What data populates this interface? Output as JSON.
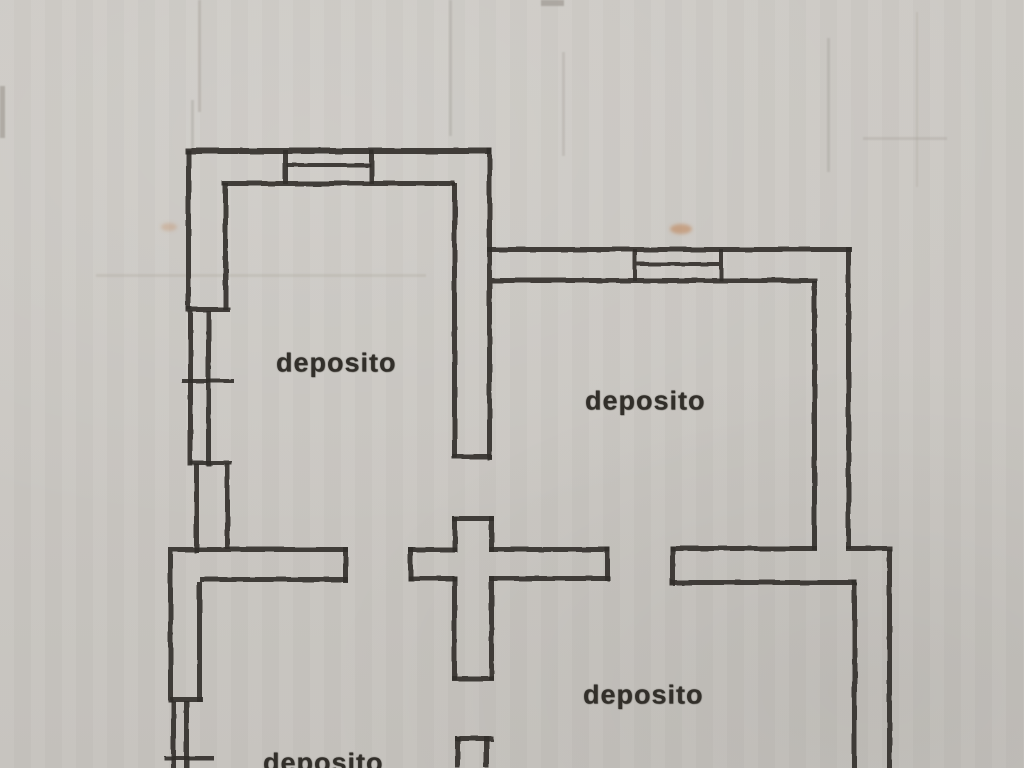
{
  "document": {
    "kind": "scanned cadastral floor plan (planimetria)",
    "language": "it"
  },
  "colors": {
    "paper": "#cac7c2",
    "ink": "#33302b",
    "faint": "#a9a49d",
    "smudge": "#c08050"
  },
  "rooms": [
    {
      "id": "deposito-1",
      "label": "deposito",
      "x": 276,
      "y": 348
    },
    {
      "id": "deposito-2",
      "label": "deposito",
      "x": 585,
      "y": 386
    },
    {
      "id": "deposito-3",
      "label": "deposito",
      "x": 583,
      "y": 680
    },
    {
      "id": "deposito-4",
      "label": "deposito",
      "x": 263,
      "y": 748
    }
  ],
  "plan": {
    "width": 1024,
    "height": 768,
    "walls": [
      {
        "x": 185,
        "y": 148,
        "w": 307,
        "h": 6
      },
      {
        "x": 283,
        "y": 150,
        "w": 5,
        "h": 34
      },
      {
        "x": 369,
        "y": 150,
        "w": 5,
        "h": 34
      },
      {
        "x": 287,
        "y": 163,
        "w": 84,
        "h": 4
      },
      {
        "x": 222,
        "y": 181,
        "w": 233,
        "h": 5
      },
      {
        "x": 186,
        "y": 150,
        "w": 5,
        "h": 160
      },
      {
        "x": 223,
        "y": 183,
        "w": 5,
        "h": 127
      },
      {
        "x": 186,
        "y": 307,
        "w": 44,
        "h": 5
      },
      {
        "x": 188,
        "y": 311,
        "w": 5,
        "h": 155
      },
      {
        "x": 206,
        "y": 311,
        "w": 5,
        "h": 155
      },
      {
        "x": 182,
        "y": 379,
        "w": 52,
        "h": 4
      },
      {
        "x": 190,
        "y": 461,
        "w": 42,
        "h": 4
      },
      {
        "x": 194,
        "y": 464,
        "w": 5,
        "h": 89
      },
      {
        "x": 225,
        "y": 464,
        "w": 5,
        "h": 85
      },
      {
        "x": 452,
        "y": 183,
        "w": 5,
        "h": 275
      },
      {
        "x": 487,
        "y": 148,
        "w": 5,
        "h": 312
      },
      {
        "x": 452,
        "y": 454,
        "w": 40,
        "h": 5
      },
      {
        "x": 487,
        "y": 247,
        "w": 365,
        "h": 5
      },
      {
        "x": 492,
        "y": 278,
        "w": 325,
        "h": 5
      },
      {
        "x": 633,
        "y": 249,
        "w": 4,
        "h": 32
      },
      {
        "x": 719,
        "y": 249,
        "w": 4,
        "h": 32
      },
      {
        "x": 637,
        "y": 262,
        "w": 82,
        "h": 4
      },
      {
        "x": 812,
        "y": 281,
        "w": 5,
        "h": 269
      },
      {
        "x": 846,
        "y": 247,
        "w": 5,
        "h": 302
      },
      {
        "x": 168,
        "y": 547,
        "w": 180,
        "h": 5
      },
      {
        "x": 343,
        "y": 547,
        "w": 5,
        "h": 36
      },
      {
        "x": 200,
        "y": 577,
        "w": 148,
        "h": 5
      },
      {
        "x": 408,
        "y": 547,
        "w": 49,
        "h": 5
      },
      {
        "x": 408,
        "y": 547,
        "w": 5,
        "h": 34
      },
      {
        "x": 489,
        "y": 547,
        "w": 121,
        "h": 5
      },
      {
        "x": 408,
        "y": 576,
        "w": 49,
        "h": 5
      },
      {
        "x": 489,
        "y": 576,
        "w": 121,
        "h": 5
      },
      {
        "x": 605,
        "y": 547,
        "w": 5,
        "h": 34
      },
      {
        "x": 452,
        "y": 516,
        "w": 42,
        "h": 5
      },
      {
        "x": 452,
        "y": 516,
        "w": 5,
        "h": 36
      },
      {
        "x": 489,
        "y": 516,
        "w": 5,
        "h": 36
      },
      {
        "x": 452,
        "y": 576,
        "w": 5,
        "h": 104
      },
      {
        "x": 489,
        "y": 576,
        "w": 5,
        "h": 104
      },
      {
        "x": 452,
        "y": 676,
        "w": 42,
        "h": 5
      },
      {
        "x": 670,
        "y": 546,
        "w": 147,
        "h": 5
      },
      {
        "x": 670,
        "y": 546,
        "w": 5,
        "h": 40
      },
      {
        "x": 670,
        "y": 580,
        "w": 187,
        "h": 5
      },
      {
        "x": 846,
        "y": 546,
        "w": 46,
        "h": 5
      },
      {
        "x": 852,
        "y": 580,
        "w": 5,
        "h": 188
      },
      {
        "x": 887,
        "y": 549,
        "w": 5,
        "h": 219
      },
      {
        "x": 455,
        "y": 736,
        "w": 38,
        "h": 5
      },
      {
        "x": 455,
        "y": 736,
        "w": 5,
        "h": 32
      },
      {
        "x": 484,
        "y": 736,
        "w": 5,
        "h": 32
      },
      {
        "x": 168,
        "y": 552,
        "w": 5,
        "h": 150
      },
      {
        "x": 197,
        "y": 582,
        "w": 5,
        "h": 120
      },
      {
        "x": 170,
        "y": 697,
        "w": 33,
        "h": 5
      },
      {
        "x": 171,
        "y": 701,
        "w": 5,
        "h": 67
      },
      {
        "x": 184,
        "y": 701,
        "w": 5,
        "h": 67
      },
      {
        "x": 164,
        "y": 756,
        "w": 50,
        "h": 4
      }
    ],
    "artifacts": [
      {
        "x": 198,
        "y": 0,
        "w": 3,
        "h": 112,
        "o": 0.5
      },
      {
        "x": 191,
        "y": 100,
        "w": 3,
        "h": 52,
        "o": 0.45
      },
      {
        "x": 449,
        "y": 0,
        "w": 3,
        "h": 136,
        "o": 0.45
      },
      {
        "x": 562,
        "y": 52,
        "w": 3,
        "h": 104,
        "o": 0.4
      },
      {
        "x": 827,
        "y": 38,
        "w": 3,
        "h": 134,
        "o": 0.45
      },
      {
        "x": 916,
        "y": 12,
        "w": 2,
        "h": 175,
        "o": 0.3
      },
      {
        "x": 863,
        "y": 137,
        "w": 84,
        "h": 3,
        "o": 0.4
      },
      {
        "x": 96,
        "y": 274,
        "w": 330,
        "h": 3,
        "o": 0.3
      },
      {
        "x": 0,
        "y": 86,
        "w": 5,
        "h": 52,
        "o": 0.85
      },
      {
        "x": 541,
        "y": 0,
        "w": 23,
        "h": 6,
        "o": 0.9
      }
    ],
    "smudges": [
      {
        "cx": 681,
        "cy": 229,
        "rx": 11,
        "ry": 5,
        "o": 0.55
      },
      {
        "cx": 169,
        "cy": 227,
        "rx": 8,
        "ry": 4,
        "o": 0.3
      }
    ]
  }
}
